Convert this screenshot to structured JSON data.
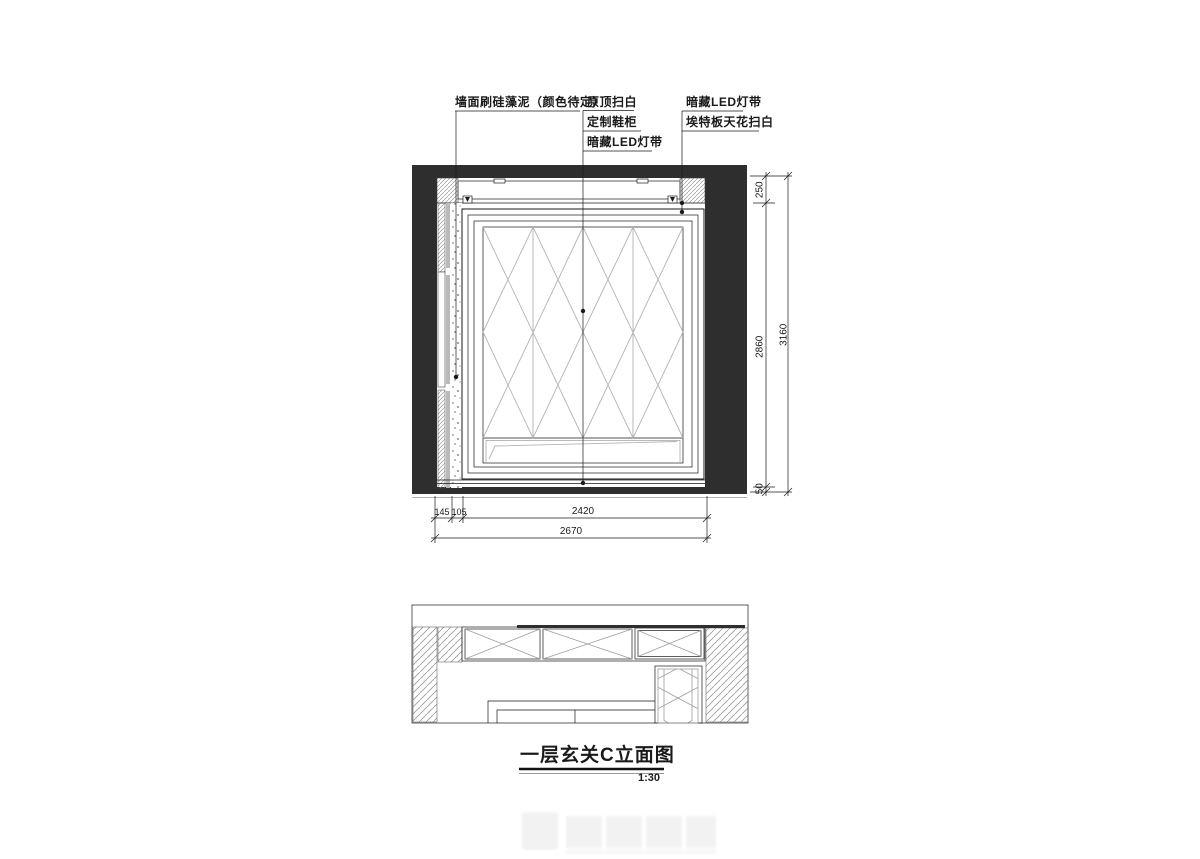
{
  "annotations": {
    "left": {
      "lines": [
        {
          "text": "墙面刷硅藻泥（颜色待定）"
        }
      ]
    },
    "middle": {
      "lines": [
        {
          "text": "原顶扫白"
        },
        {
          "text": "定制鞋柜"
        },
        {
          "text": "暗藏LED灯带"
        }
      ]
    },
    "right": {
      "lines": [
        {
          "text": "暗藏LED灯带"
        },
        {
          "text": "埃特板天花扫白"
        }
      ]
    }
  },
  "dimensions": {
    "right_chain": {
      "top": "250",
      "middle": "2860",
      "bottom": "50",
      "total": "3160"
    },
    "bottom_chain": {
      "left": "145",
      "second": "105",
      "main": "2420",
      "total": "2670"
    }
  },
  "title_block": {
    "title": "一层玄关C立面图",
    "scale": "1:30"
  },
  "colors": {
    "ink": "#1a1a1a",
    "solid_fill": "#2e2e2e",
    "light_line": "#b3b3b3",
    "hatch_line": "#9a9a9a"
  }
}
